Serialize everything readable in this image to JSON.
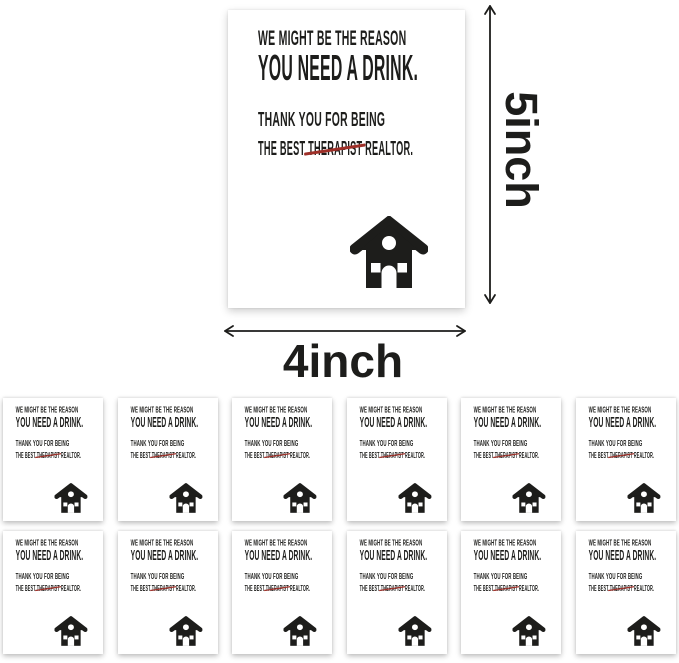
{
  "product": {
    "card": {
      "line1": "WE MIGHT BE THE REASON",
      "line2": "YOU NEED A DRINK.",
      "line3": "THANK YOU FOR BEING",
      "line4": {
        "prefix": "THE BEST ",
        "struck": "THERAPIST",
        "suffix": " REALTOR."
      },
      "icon": "house-icon"
    },
    "dimensions": {
      "height_label": "5inch",
      "width_label": "4inch"
    },
    "pack": {
      "rows": 2,
      "columns": 6,
      "total_cards": 12
    }
  },
  "colors": {
    "page-bg": "#ffffff",
    "card-bg": "#ffffff",
    "ink": "#1d1d1b",
    "strike": "#9e2f28",
    "arrow": "#1d1d1b"
  }
}
